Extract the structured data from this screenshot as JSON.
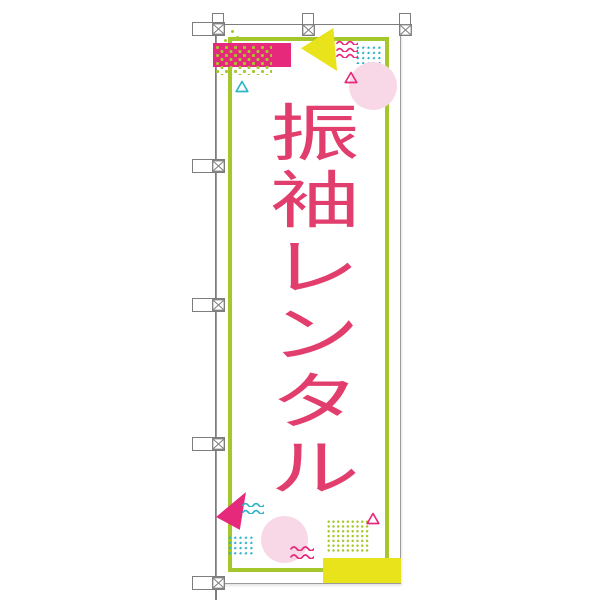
{
  "banner": {
    "text": "振袖レンタル",
    "chars": [
      "振",
      "袖",
      "レ",
      "ン",
      "タ",
      "ル"
    ]
  },
  "colors": {
    "text_pink": "#e13e6e",
    "magenta": "#e7297c",
    "yellow": "#e9e31c",
    "yellow_green": "#a5c72b",
    "teal": "#2fb5c8",
    "light_pink": "#f8d8e6",
    "pole_gray": "#7d7d7d"
  }
}
